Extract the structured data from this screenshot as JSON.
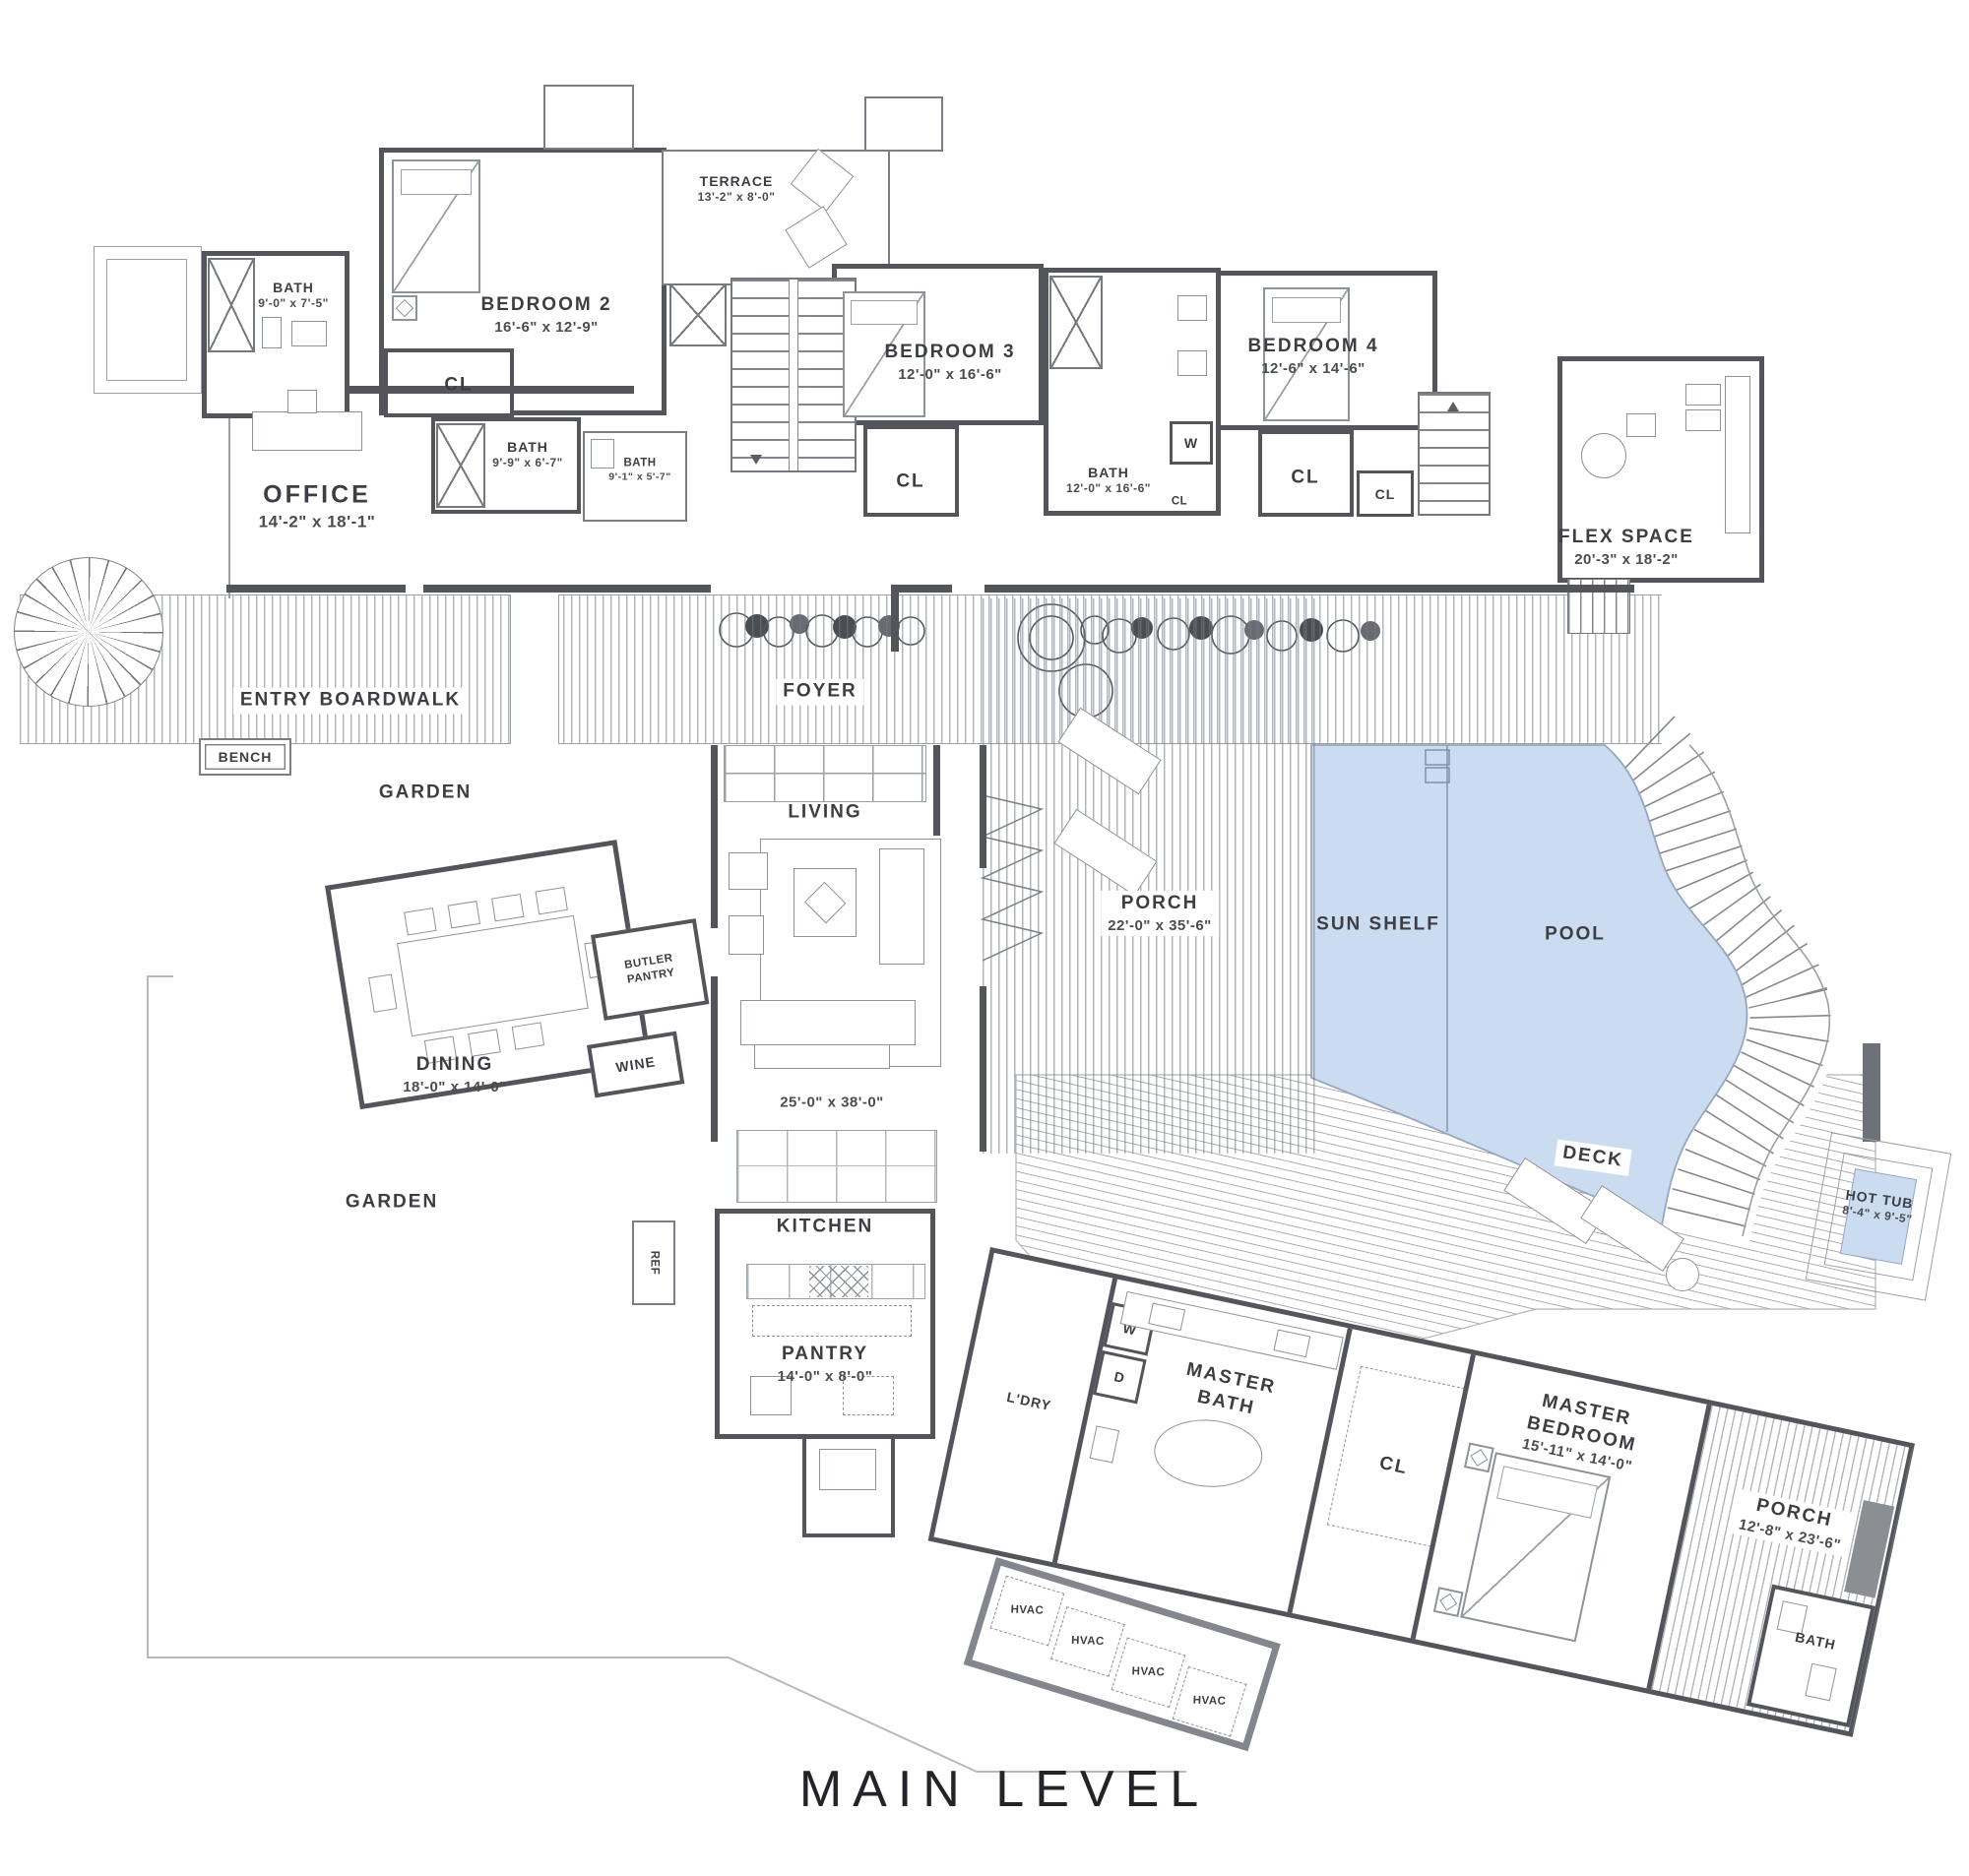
{
  "title": "MAIN LEVEL",
  "colors": {
    "wall": "#53555a",
    "pool_fill": "#cbdcf0",
    "pool_edge": "#97a7bd",
    "hatch_line": "#747a82",
    "text": "#3c3e44"
  },
  "labels": {
    "bath_tl": {
      "n": "BATH",
      "d": "9'-0\" x 7'-5\""
    },
    "bedroom2": {
      "n": "BEDROOM 2",
      "d": "16'-6\" x 12'-9\""
    },
    "terrace": {
      "n": "TERRACE",
      "d": "13'-2\" x 8'-0\""
    },
    "cl": {
      "n": "CL"
    },
    "bath2": {
      "n": "BATH",
      "d": "9'-9\" x 6'-7\""
    },
    "bath3": {
      "n": "BATH",
      "d": "9'-1\" x 5'-7\""
    },
    "office": {
      "n": "OFFICE",
      "d": "14'-2\" x 18'-1\""
    },
    "bedroom3": {
      "n": "BEDROOM 3",
      "d": "12'-0\" x 16'-6\""
    },
    "bath4": {
      "n": "BATH",
      "d": "12'-0\" x 16'-6\""
    },
    "w": {
      "n": "W"
    },
    "d": {
      "n": "D"
    },
    "bedroom4": {
      "n": "BEDROOM 4",
      "d": "12'-6\" x 14'-6\""
    },
    "flex": {
      "n": "FLEX SPACE",
      "d": "20'-3\" x 18'-2\""
    },
    "entry": {
      "n": "ENTRY BOARDWALK"
    },
    "bench": {
      "n": "BENCH"
    },
    "foyer": {
      "n": "FOYER"
    },
    "garden": {
      "n": "GARDEN"
    },
    "dining": {
      "n": "DINING",
      "d": "18'-0\" x 14'-0\""
    },
    "butler": {
      "n": "BUTLER PANTRY"
    },
    "wine": {
      "n": "WINE"
    },
    "ref": {
      "n": "REF"
    },
    "living": {
      "n": "LIVING"
    },
    "living_dims": {
      "d": "25'-0\" x 38'-0\""
    },
    "kitchen": {
      "n": "KITCHEN"
    },
    "pantry": {
      "n": "PANTRY",
      "d": "14'-0\" x 8'-0\""
    },
    "porch_main": {
      "n": "PORCH",
      "d": "22'-0\" x 35'-6\""
    },
    "sun_shelf": {
      "n": "SUN SHELF"
    },
    "pool": {
      "n": "POOL"
    },
    "deck": {
      "n": "DECK"
    },
    "hot_tub": {
      "n": "HOT TUB",
      "d": "8'-4\" x 9'-5\""
    },
    "ldry": {
      "n": "L'DRY"
    },
    "master_bath": {
      "n": "MASTER BATH"
    },
    "master_bed": {
      "n": "MASTER BEDROOM",
      "d": "15'-11\" x 14'-0\""
    },
    "porch2": {
      "n": "PORCH",
      "d": "12'-8\" x 23'-6\""
    },
    "bath_plain": {
      "n": "BATH"
    },
    "hvac": {
      "n": "HVAC"
    }
  }
}
